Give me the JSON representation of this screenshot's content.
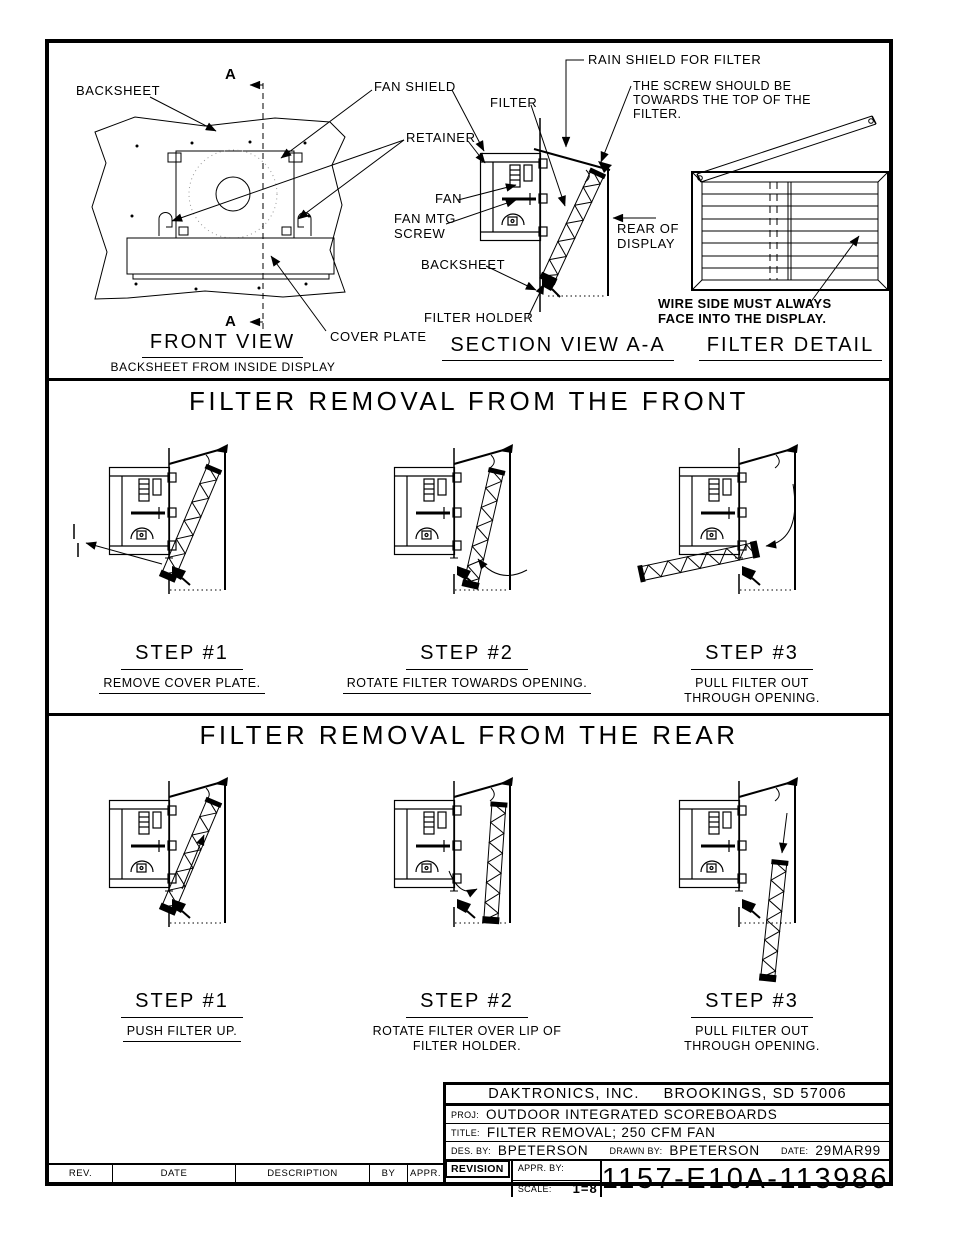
{
  "top": {
    "front_view": {
      "backsheet_label": "BACKSHEET",
      "section_marker": "A",
      "cover_plate_label": "COVER PLATE",
      "title": "FRONT VIEW",
      "subtitle": "BACKSHEET FROM INSIDE DISPLAY"
    },
    "callouts": {
      "fan_shield": "FAN SHIELD",
      "retainer": "RETAINER",
      "filter": "FILTER",
      "fan": "FAN",
      "fan_mtg_1": "FAN MTG",
      "fan_mtg_2": "SCREW",
      "backsheet": "BACKSHEET",
      "filter_holder": "FILTER HOLDER",
      "rain_shield": "RAIN SHIELD FOR FILTER",
      "screw_note_1": "THE SCREW SHOULD BE",
      "screw_note_2": "TOWARDS THE TOP OF THE",
      "screw_note_3": "FILTER.",
      "rear_1": "REAR OF",
      "rear_2": "DISPLAY"
    },
    "section_view": {
      "title": "SECTION VIEW A-A"
    },
    "filter_detail": {
      "title": "FILTER DETAIL",
      "wire_note_1": "WIRE SIDE MUST ALWAYS",
      "wire_note_2": "FACE INTO THE DISPLAY."
    }
  },
  "front_removal": {
    "title": "FILTER REMOVAL FROM THE FRONT",
    "steps": [
      {
        "label": "STEP #1",
        "desc": [
          "REMOVE COVER PLATE."
        ]
      },
      {
        "label": "STEP #2",
        "desc": [
          "ROTATE FILTER TOWARDS OPENING."
        ]
      },
      {
        "label": "STEP #3",
        "desc": [
          "PULL FILTER OUT",
          "THROUGH OPENING."
        ]
      }
    ]
  },
  "rear_removal": {
    "title": "FILTER REMOVAL FROM THE REAR",
    "steps": [
      {
        "label": "STEP #1",
        "desc": [
          "PUSH FILTER UP."
        ]
      },
      {
        "label": "STEP #2",
        "desc": [
          "ROTATE FILTER OVER LIP OF",
          "FILTER HOLDER."
        ]
      },
      {
        "label": "STEP #3",
        "desc": [
          "PULL FILTER OUT",
          "THROUGH OPENING."
        ]
      }
    ]
  },
  "title_block": {
    "company_name": "DAKTRONICS, INC.",
    "company_city": "BROOKINGS, SD 57006",
    "proj_label": "PROJ:",
    "proj": "OUTDOOR INTEGRATED SCOREBOARDS",
    "title_label": "TITLE:",
    "title": "FILTER REMOVAL; 250 CFM FAN",
    "des_label": "DES. BY:",
    "des": "BPETERSON",
    "drawn_label": "DRAWN BY:",
    "drawn": "BPETERSON",
    "date_label": "DATE:",
    "date": "29MAR99",
    "revision_label": "REVISION",
    "appr_label": "APPR. BY:",
    "scale_label": "SCALE:",
    "scale": "1=8",
    "drawing_number": "1157-E10A-113986"
  },
  "revision_strip": {
    "headers": [
      "REV.",
      "DATE",
      "DESCRIPTION",
      "BY",
      "APPR."
    ]
  },
  "colors": {
    "ink": "#000000",
    "paper": "#ffffff"
  }
}
